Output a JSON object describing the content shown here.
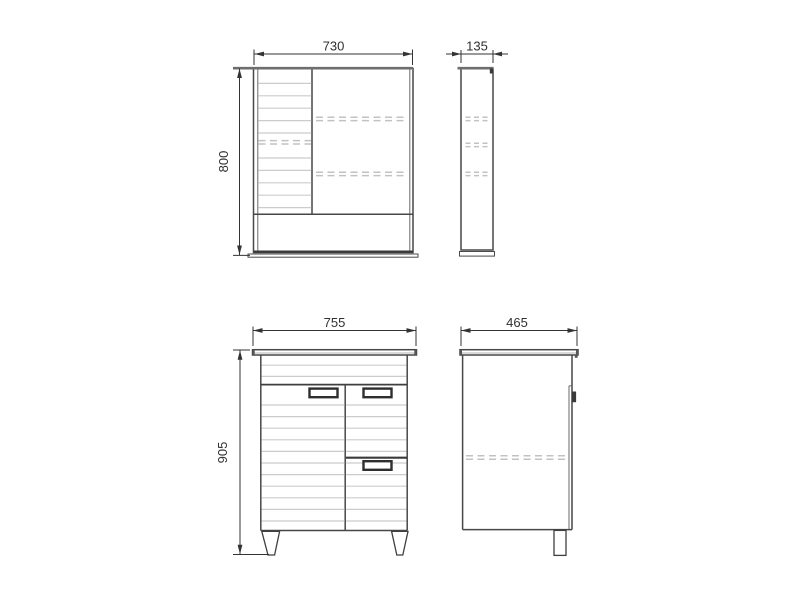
{
  "drawing": {
    "title": "Bathroom furniture set — dimensional drawing",
    "units": "mm",
    "colors": {
      "line_dark": "#474747",
      "line_light": "#cccccc",
      "dash": "#c2c2c2",
      "dim_text": "#303030",
      "background": "#ffffff"
    },
    "views": {
      "mirror_front": {
        "name": "mirror-cabinet-front-view",
        "width_label": "730",
        "height_label": "800"
      },
      "mirror_side": {
        "name": "mirror-cabinet-side-view",
        "depth_label": "135"
      },
      "vanity_front": {
        "name": "vanity-front-view",
        "width_label": "755",
        "height_label": "905"
      },
      "vanity_side": {
        "name": "vanity-side-view",
        "depth_label": "465"
      }
    }
  }
}
